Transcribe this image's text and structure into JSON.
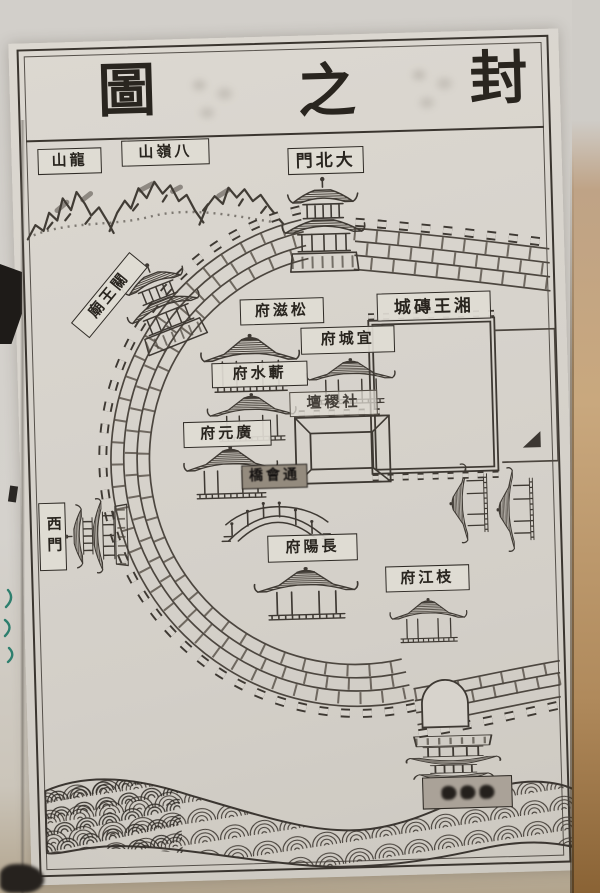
{
  "title": {
    "chars": [
      "圖",
      "之",
      "封"
    ]
  },
  "labels": {
    "longshan": "山龍",
    "balingshan": "山嶺八",
    "dabeimen": "門北大",
    "guanwangmiao": "廟王關",
    "xiangwang_zhuancheng": "城磚王湘",
    "songzifu": "府滋松",
    "yichengfu": "府城宜",
    "qishuifu": "府水蘄",
    "shejitan": "壇稷社",
    "guangyuanfu": "府元廣",
    "tonghuiqiao": "橋會通",
    "ximen": "西門",
    "changyangfu": "府陽長",
    "zhijiangfu": "府江枝",
    "river_gate_label_illegible": ""
  },
  "colors": {
    "paper": "#d7d3cc",
    "ink": "#3e3933",
    "label_ink": "#29251f",
    "book_edge": "#b9956a",
    "teal_mark": "#2e7f6e"
  }
}
